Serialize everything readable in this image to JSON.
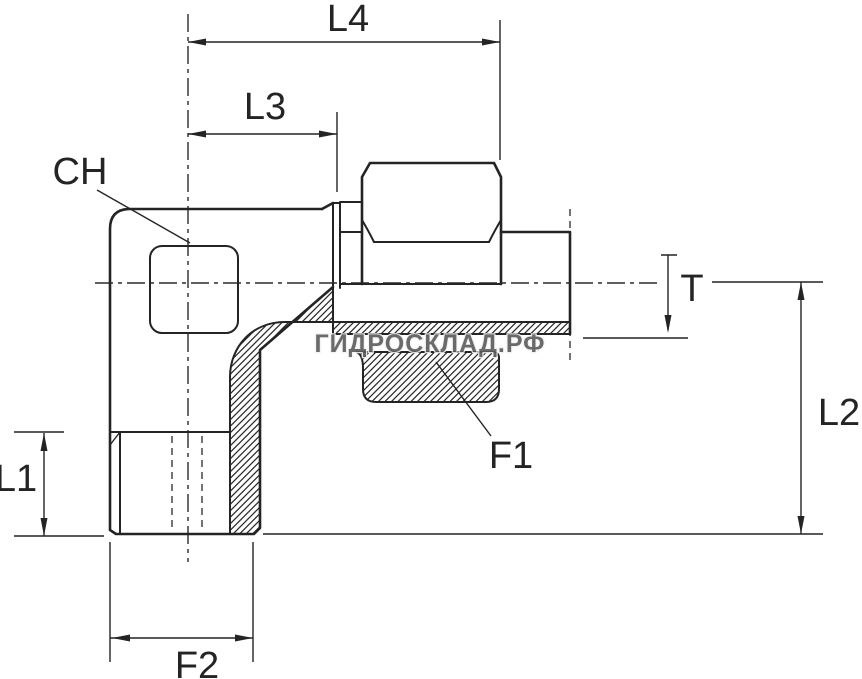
{
  "drawing": {
    "title_hint": "90-degree elbow tube fitting, sectioned dimensional drawing",
    "colors": {
      "background": "#ffffff",
      "line": "#242424",
      "watermark_fill": "#5a5a5a",
      "watermark_halo": "#f2f2f2"
    },
    "labels": {
      "l4": "L4",
      "l3": "L3",
      "ch": "CH",
      "t": "T",
      "l2": "L2",
      "l1": "L1",
      "f1": "F1",
      "f2": "F2"
    },
    "watermark": {
      "text": "ГИДРОСКЛАД.РФ"
    }
  }
}
